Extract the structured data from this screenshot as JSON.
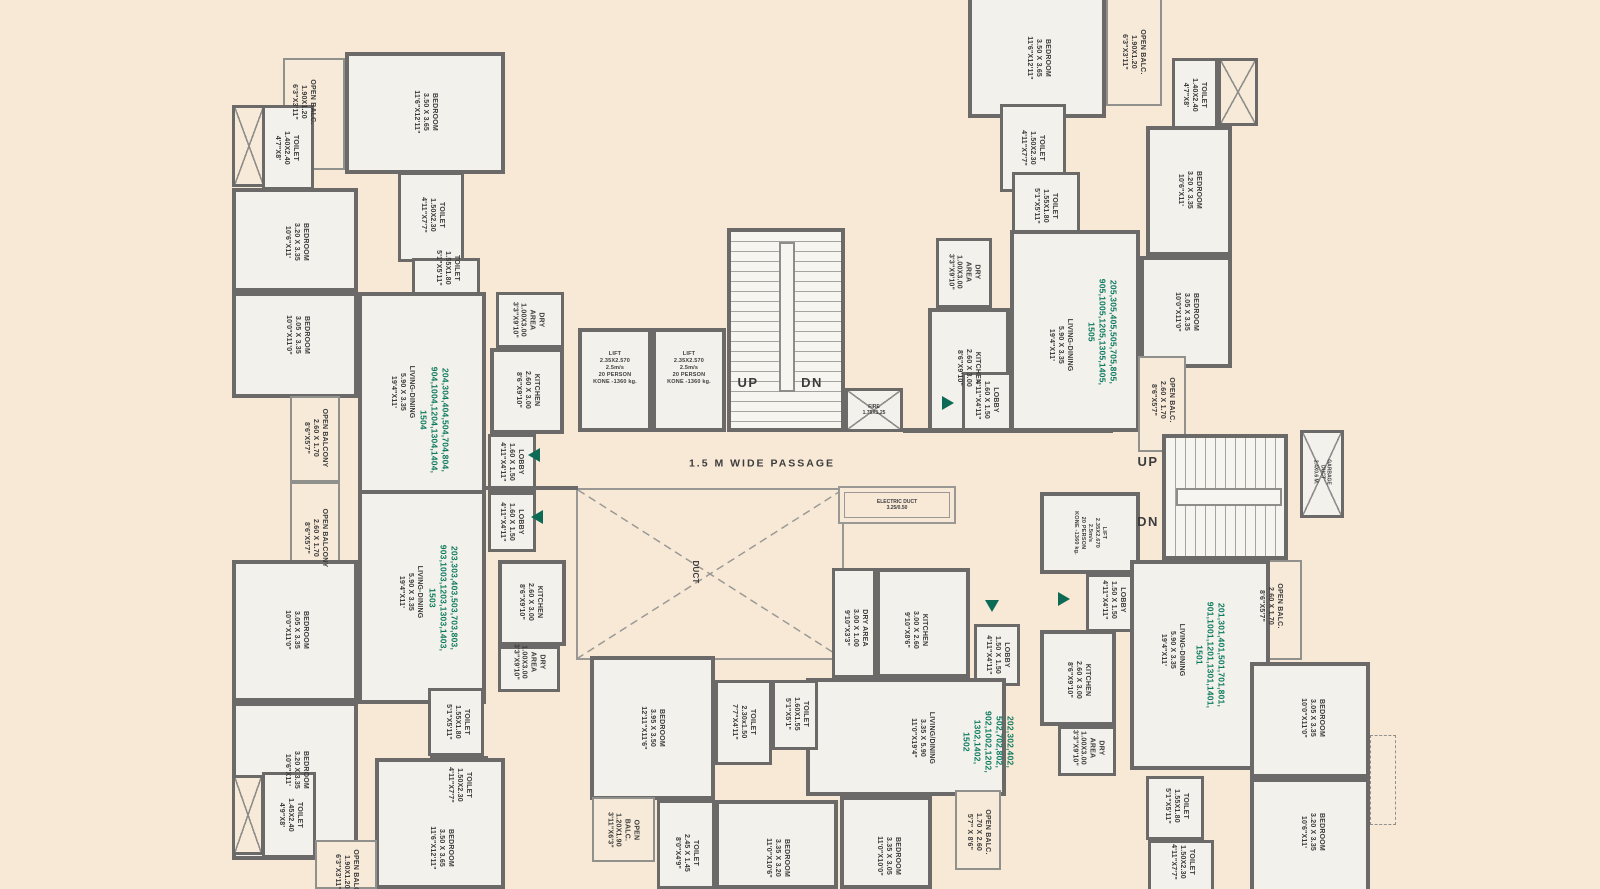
{
  "colors": {
    "background": "#f8e9d7",
    "wall": "#6b6a68",
    "floor": "#f3f1ec",
    "unit_number_green": "#0c7a5e",
    "arrow_green": "#0d6b55",
    "text": "#3c3c3c"
  },
  "labels": {
    "passage": "1.5 M WIDE PASSAGE",
    "up": "UP",
    "dn": "DN",
    "duct": "DUCT",
    "fire": "FIRE\n1.75X1.25",
    "electric_duct": "ELECTRIC DUCT\n3.25/0.50",
    "garbage_duct": "GARBAGE\nDUCT\n2.4X0.6 M.",
    "lift_small": "LIFT\n2.35X2.570\n2.5m/s\n20 PERSON\nKONE -1360 kg.",
    "lift_right": "LIFT\n2.35X2.670\n2.5m/s\n20 PERSON\nKONE -1360 kg.",
    "unit_1504_nos": "204,304,404,504,704,804,\n904,1004,1204,1304,1404,\n1504",
    "unit_1503_nos": "203,303,403,503,703,803,\n903,1003,1203,1303,1403,\n1503",
    "unit_1505_nos": "205,305,405,505,705,805,\n905,1005,1205,1305,1405,\n1505",
    "unit_1501_nos": "201,301,401,501,701,801,\n901,1001,1201,1301,1401,\n1501",
    "unit_1502_nos": "202,302,402,\n502,702,802,\n902,1002,1202,\n1302,1402,\n1502",
    "living_dining": "LIVING-DINING\n5.90 X 3.35\n19'4\"X11'",
    "living_dining_1502": "LIVING/DINING\n3.35 X 5.90\n11'0\"X19'4\"",
    "bedroom_350": "BEDROOM\n3.50 X 3.65\n11'6\"X12'11\"",
    "bedroom_320": "BEDROOM\n3.20 X 3.35\n10'6\"X11'",
    "bedroom_305": "BEDROOM\n3.05 X 3.35\n10'0\"X11'0\"",
    "bedroom_395": "BEDROOM\n3.95 X 3.50\n12'11\"X11'6\"",
    "bedroom_335_320": "BEDROOM\n3.35 X 3.20\n11'0\"X10'6\"",
    "bedroom_335_305": "BEDROOM\n3.35 X 3.05\n11'0\"X10'0\"",
    "toilet_150_230": "TOILET\n1.50X2.30\n4'11\"X7'7\"",
    "toilet_155_180": "TOILET\n1.55X1.80\n5'1\"X5'11\"",
    "toilet_140_240": "TOILET\n1.40X2.40\n4'7\"X8'",
    "toilet_145_240": "TOILET\n1.45X2.40\n4'9\"X8'",
    "toilet_230_150": "TOILET\n2.30x1.50\n7'7\"X4'11\"",
    "toilet_160_155": "TOILET\n1.60X1.55\n5'1\"X5'1\"",
    "toilet_245_145": "TOILET\n2.45 X 1.45\n8'0\"X4'9\"",
    "kitchen_260_300": "KITCHEN\n2.60 X 3.00\n8'6\"X9'10\"",
    "kitchen_300_260": "KITCHEN\n3.00 X 2.60\n9'10\"X8'6\"",
    "dry_area_v": "DRY\nAREA\n1.00X3.00\n3'3\"X9'10\"",
    "dry_area_h": "DRY AREA\n3.00 X 1.00\n9'10\"X3'3\"",
    "open_balc_190": "OPEN BALC.\n1.90X1.20\n6'3\"X3'11\"",
    "open_balcony_260": "OPEN BALCONY\n2.60 X 1.70\n8'6\"X5'7\"",
    "open_balc_260": "OPEN BALC.\n2.60 X 1.70\n8'6\"X5'7\"",
    "open_balc_170": "OPEN BALC.\n1.70 X 2.60\n5'7\" X 8'6\"",
    "open_balc_120": "OPEN\nBALC.\n1.20X1.90\n3'11\"X6'3\"",
    "lobby_160": "LOBBY\n1.60 X 1.50\n4'11\"X4'11\"",
    "lobby_150": "LOBBY\n1.50 X 1.50\n4'11\"X4'11\""
  }
}
